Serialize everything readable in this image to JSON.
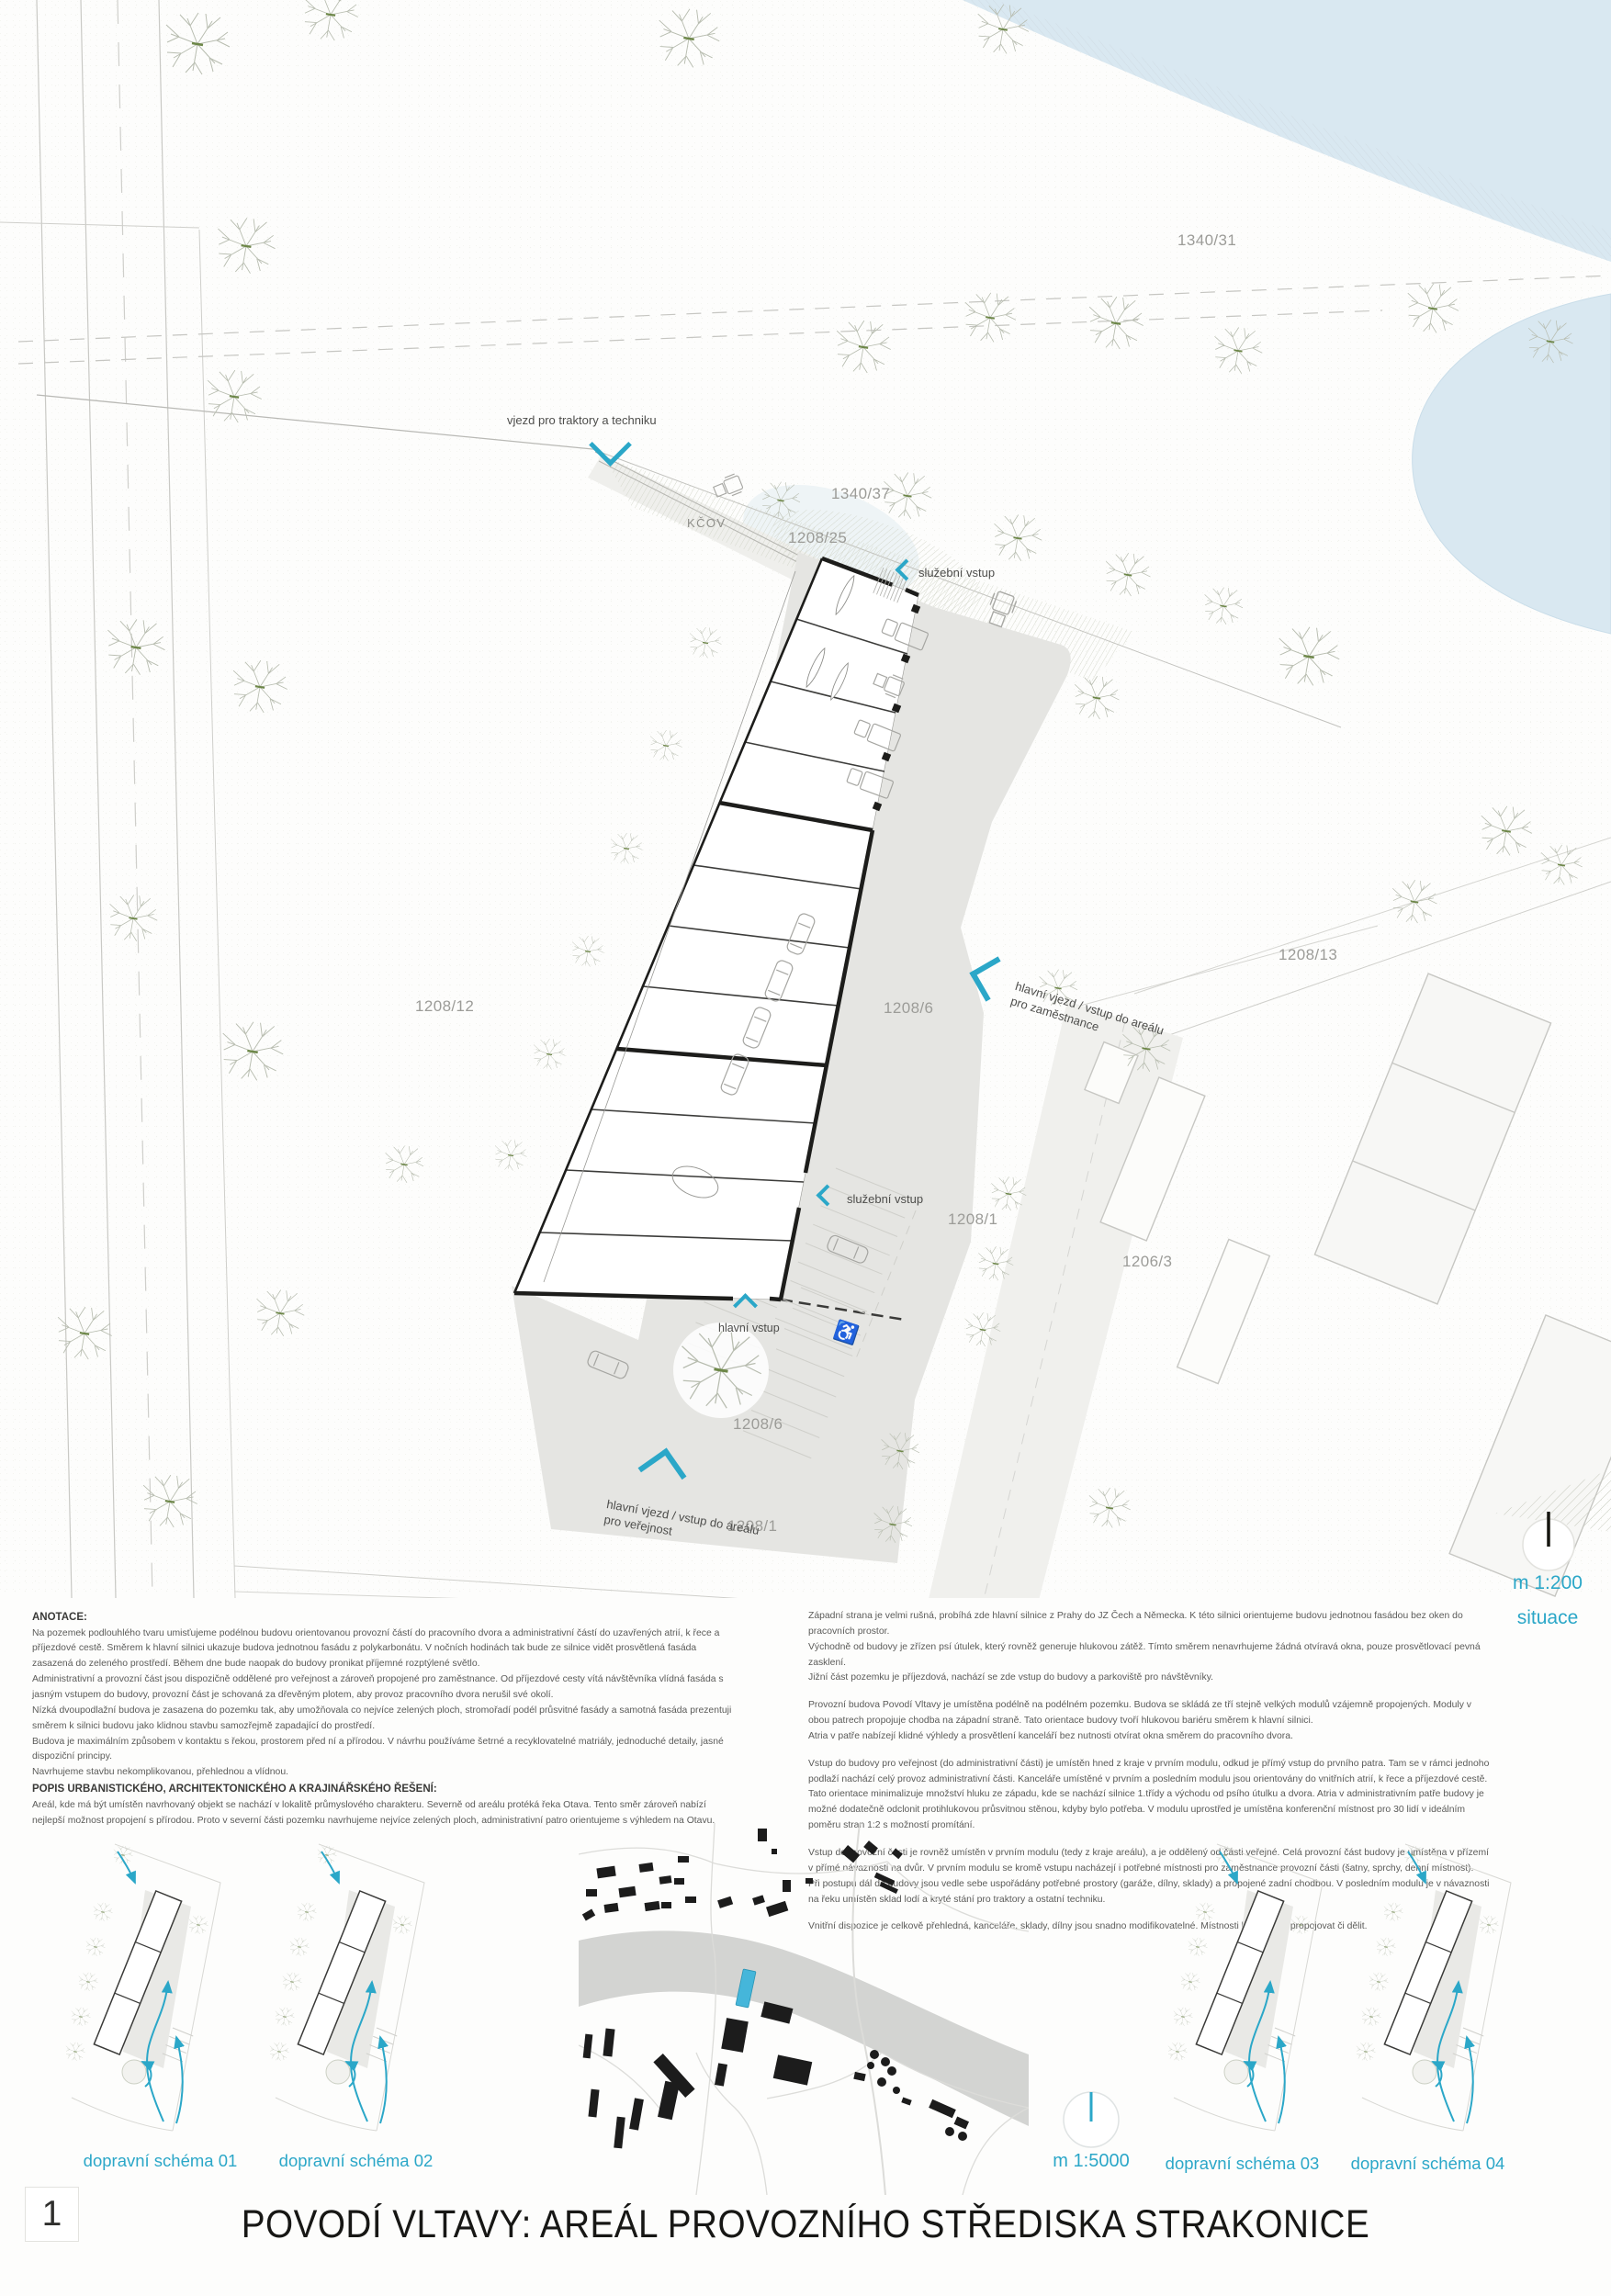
{
  "colors": {
    "accent": "#2ba7c8",
    "water": "#d9e8f1",
    "yard": "#e5e5e2",
    "ink": "#1d1d1b",
    "muted": "#9c9c98"
  },
  "sheet": {
    "number": "1",
    "title": "POVODÍ VLTAVY: AREÁL PROVOZNÍHO STŘEDISKA STRAKONICE"
  },
  "site_plan": {
    "scale_label": "m 1:200",
    "drawing_label": "situace",
    "area_label": "KČOV",
    "parcels": [
      {
        "id": "1340/31"
      },
      {
        "id": "1340/37"
      },
      {
        "id": "1208/25"
      },
      {
        "id": "1208/12"
      },
      {
        "id": "1208/6"
      },
      {
        "id": "1208/13"
      },
      {
        "id": "1208/1"
      },
      {
        "id": "1206/3"
      },
      {
        "id": "1208/6"
      },
      {
        "id": "1208/1"
      }
    ],
    "entrances": [
      {
        "label": "vjezd pro traktory a techniku"
      },
      {
        "label": "služební vstup"
      },
      {
        "label": "hlavní vjezd / vstup do areálu pro zaměstnance"
      },
      {
        "label": "služební vstup"
      },
      {
        "label": "hlavní vstup"
      },
      {
        "label": "hlavní vjezd / vstup do areálu pro veřejnost"
      }
    ],
    "icons": {
      "accessible_parking": "♿"
    }
  },
  "notes_left": {
    "heading": "ANOTACE:",
    "paragraphs": [
      "Na pozemek podlouhlého tvaru umisťujeme podélnou budovu orientovanou provozní částí do pracovního dvora a administrativní částí do uzavřených atrií, k řece a příjezdové cestě. Směrem k hlavní silnici ukazuje budova jednotnou fasádu z polykarbonátu. V nočních hodinách tak bude ze silnice vidět prosvětlená fasáda zasazená do zeleného prostředí. Během dne bude naopak do budovy pronikat příjemné rozptýlené světlo.",
      "Administrativní a provozní část jsou dispozičně oddělené pro veřejnost a zároveň propojené pro zaměstnance. Od příjezdové cesty vítá návštěvníka vlídná fasáda s jasným vstupem do budovy, provozní část je schovaná za dřevěným plotem, aby provoz pracovního dvora nerušil své okolí.",
      "Nízká dvoupodlažní budova je zasazena do pozemku tak, aby umožňovala co nejvíce zelených ploch, stromořadí podél průsvitné fasády a samotná fasáda prezentuji směrem k silnici budovu jako klidnou stavbu samozřejmě zapadající do prostředí.",
      "Budova je maximálním způsobem v kontaktu s řekou, prostorem před ní a přírodou. V návrhu používáme šetrné a recyklovatelné matriály, jednoduché detaily, jasné dispoziční principy.",
      "Navrhujeme stavbu nekomplikovanou, přehlednou a vlídnou."
    ],
    "subheading": "POPIS URBANISTICKÉHO, ARCHITEKTONICKÉHO A KRAJINÁŘSKÉHO ŘEŠENÍ:",
    "paragraphs2": [
      "Areál, kde má být umístěn navrhovaný objekt se nachází v lokalitě průmyslového charakteru. Severně od areálu protéká řeka Otava. Tento směr zároveň nabízí nejlepší možnost propojení s přírodou. Proto v severní části pozemku navrhujeme nejvíce zelených ploch, administrativní patro orientujeme s výhledem na Otavu."
    ]
  },
  "notes_right": {
    "paragraphs": [
      "Západní strana je velmi rušná, probíhá zde hlavní silnice z Prahy do JZ Čech a Německa. K této silnici orientujeme budovu jednotnou fasádou bez oken do pracovních prostor.",
      "Východně od budovy je zřízen psí útulek, který rovněž generuje hlukovou zátěž. Tímto směrem nenavrhujeme žádná otvíravá okna, pouze prosvětlovací pevná zasklení.",
      "Jižní část pozemku je příjezdová, nachází se zde vstup do budovy a parkoviště pro návštěvníky.",
      "Provozní budova Povodí Vltavy je umístěna podélně na podélném pozemku. Budova se skládá ze tří stejně velkých modulů vzájemně propojených. Moduly v obou patrech propojuje chodba na západní straně. Tato orientace budovy tvoří hlukovou bariéru směrem k hlavní silnici.",
      "Atria v patře nabízejí klidné výhledy a prosvětlení kanceláří bez nutnosti otvírat okna směrem do pracovního dvora.",
      "Vstup do budovy pro veřejnost (do administrativní části) je umístěn hned z kraje v prvním modulu, odkud je přímý vstup do prvního patra. Tam se v rámci jednoho podlaží nachází celý provoz administrativní části. Kanceláře umístěné v prvním a posledním modulu jsou orientovány do vnitřních atrií, k řece a příjezdové cestě. Tato orientace minimalizuje množství hluku ze západu, kde se nachází silnice 1.třídy a východu od psího útulku a dvora. Atria v administrativním patře budovy je možné dodatečně odclonit protihlukovou průsvitnou stěnou, kdyby bylo potřeba. V modulu uprostřed je umístěna konferenční místnost pro 30 lidí v ideálním poměru stran 1:2 s možností promítání.",
      "Vstup do provozní části je rovněž umístěn v prvním modulu (tedy z kraje areálu), a je oddělený od části veřejné. Celá provozní část budovy je umístěna v přízemí v přímé návaznosti na dvůr. V prvním modulu se kromě vstupu nacházejí i potřebné místnosti pro zaměstnance provozní části (šatny, sprchy, denní místnost).",
      "Při postupu dál do budovy jsou vedle sebe uspořádány potřebné prostory (garáže, dílny, sklady) a propojené zadní chodbou. V posledním modulu je v návaznosti na řeku umístěn sklad lodí a kryté stání pro traktory a ostatní techniku.",
      "Vnitřní dispozice je celkově přehledná, kanceláře, sklady, dílny jsou snadno modifikovatelné. Místnosti lze snadno propojovat či dělit."
    ]
  },
  "city_map": {
    "scale_label": "m 1:5000"
  },
  "schemes": [
    {
      "label": "dopravní schéma 01"
    },
    {
      "label": "dopravní schéma 02"
    },
    {
      "label": "dopravní schéma 03"
    },
    {
      "label": "dopravní schéma 04"
    }
  ]
}
